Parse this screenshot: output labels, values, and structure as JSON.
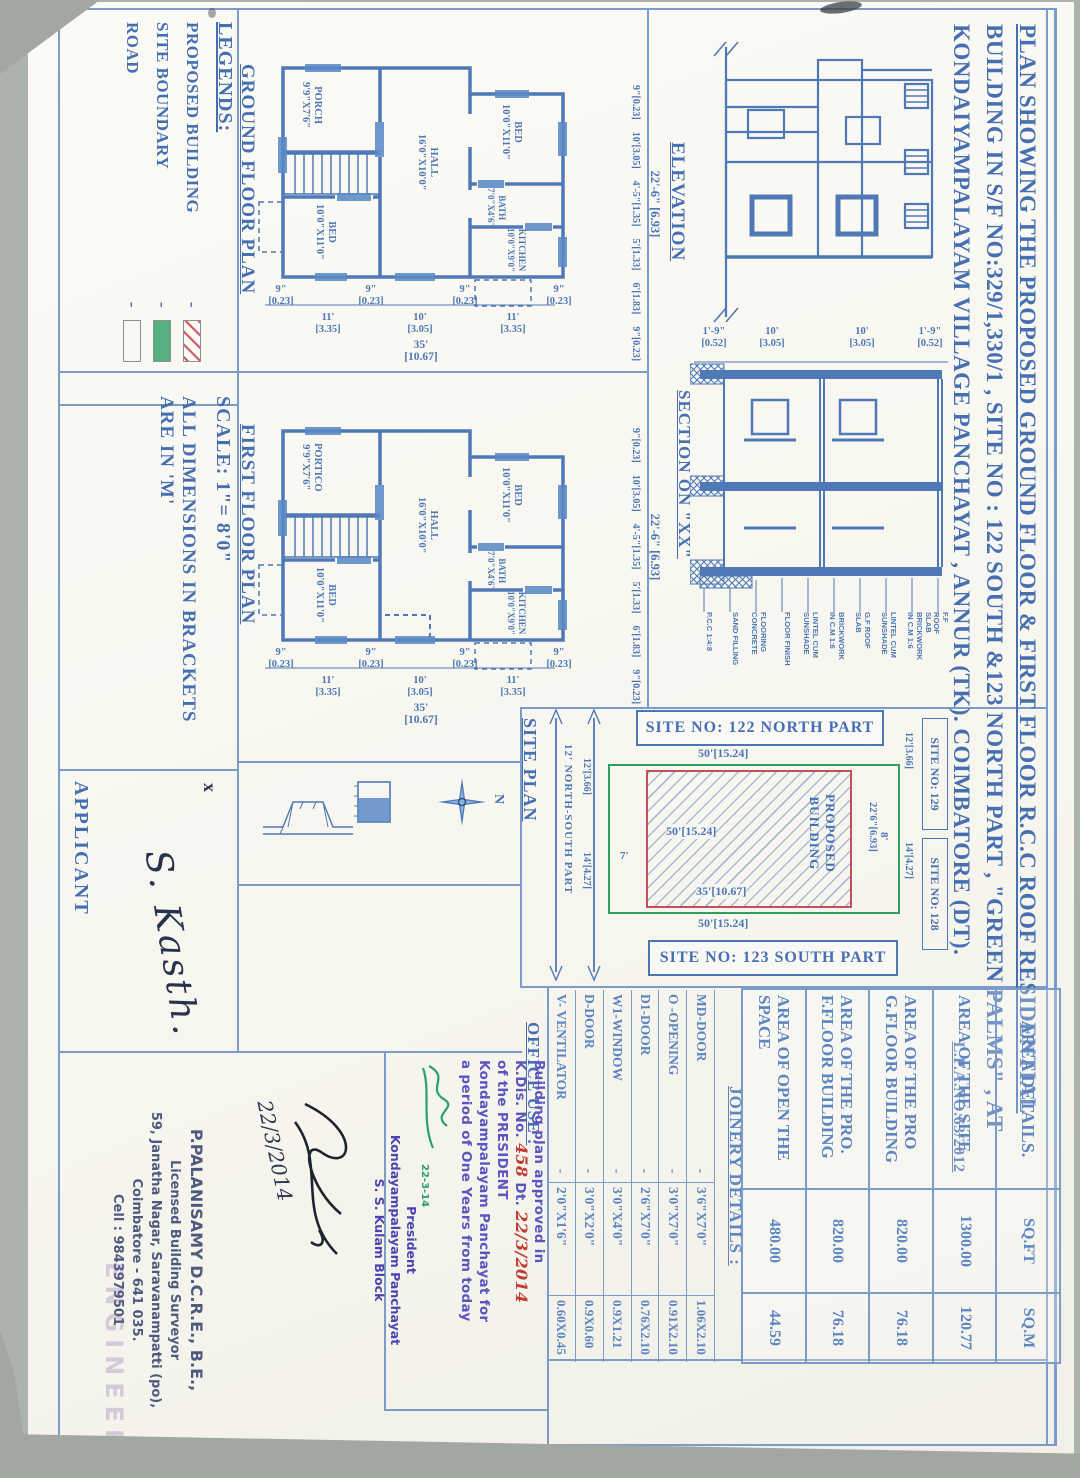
{
  "colors": {
    "ink_blue": "#4c77b4",
    "boundary_green": "#2e9e62",
    "building_red": "#c2505c",
    "stamp_violet": "#5b54c0",
    "hand_red": "#c23b32",
    "signature_green": "#2aa06a"
  },
  "sheet": {
    "title_line1": "PLAN SHOWING THE PROPOSED  GROUND FLOOR  & FIRST FLOOR R.C.C ROOF RESIDENTIAL",
    "title_line2": "BUILDING IN S/F NO:329/1,330/1 , SITE NO : 122 SOUTH &123 NORTH PART , \"GREEN PALMS\" , AT",
    "title_line3": "KONDAIYAMPALAYAM VILLAGE PANCHAYAT , ANNUR (TK). COIMBATORE (DT).",
    "lpa_no": "L.P.A.NO.63/2012"
  },
  "labels": {
    "elevation": "ELEVATION",
    "section": "SECTION ON \"XX\"",
    "ground_floor_plan": "GROUND FLOOR PLAN",
    "first_floor_plan": "FIRST FLOOR PLAN",
    "site_plan": "SITE PLAN",
    "office_use": "OFFICE USE :",
    "applicant": "APPLICANT",
    "applicant_mark": "x",
    "north_letter": "N"
  },
  "legends": {
    "title": "LEGENDS:",
    "sep": "-",
    "items": [
      "PROPOSED BUILDING",
      "SITE BOUNDARY",
      "ROAD"
    ]
  },
  "notes": {
    "scale": "SCALE: 1\"= 8'0\"",
    "dims_line1": "ALL DIMENSIONS IN BRACKETS",
    "dims_line2": "ARE IN 'M'"
  },
  "area_table": {
    "header": {
      "label": "AREA DETAILS.",
      "sqft": "SQ.FT",
      "sqm": "SQ.M"
    },
    "rows": [
      {
        "label": "AREA OF THE SITE",
        "sqft": "1300.00",
        "sqm": "120.77"
      },
      {
        "label": "AREA OF THE PRO G.FLOOR BUILDING",
        "sqft": "820.00",
        "sqm": "76.18"
      },
      {
        "label": "AREA OF THE PRO. F.FLOOR BUILDING",
        "sqft": "820.00",
        "sqm": "76.18"
      },
      {
        "label": "AREA OF OPEN THE SPACE",
        "sqft": "480.00",
        "sqm": "44.59"
      }
    ]
  },
  "joinery_table": {
    "title": "JOINERY DETAILS :",
    "rows": [
      {
        "item": "MD-DOOR",
        "sep": "-",
        "size_ft": "3'6\"X7'0\"",
        "size_m": "1.06X2.10"
      },
      {
        "item": "O -OPENING",
        "sep": "-",
        "size_ft": "3'0\"X7'0\"",
        "size_m": "0.91X2.10"
      },
      {
        "item": "D1-DOOR",
        "sep": "-",
        "size_ft": "2'6\"X7'0\"",
        "size_m": "0.76X2.10"
      },
      {
        "item": "W1-WINDOW",
        "sep": "-",
        "size_ft": "3'0\"X4'0\"",
        "size_m": "0.9X1.21"
      },
      {
        "item": "D-DOOR",
        "sep": "-",
        "size_ft": "3'0\"X2'0\"",
        "size_m": "0.9X0.60"
      },
      {
        "item": "V- VENTILATOR",
        "sep": "-",
        "size_ft": "2'0\"X1'6\"",
        "size_m": "0.60X0.45"
      }
    ]
  },
  "rooms": {
    "gf": {
      "porch": {
        "name": "PORCH",
        "size": "9'9\"X7'6\""
      },
      "hall": {
        "name": "HALL",
        "size": "16'0\"X10'0\""
      },
      "bed_a": {
        "name": "BED",
        "size": "10'0\"X11'0\""
      },
      "bed_b": {
        "name": "BED",
        "size": "10'0\"X11'0\""
      },
      "bath": {
        "name": "BATH",
        "size": "7'0\"X4'6\""
      },
      "kitchen": {
        "name": "KITCHEN",
        "size": "10'0\"X9'0\""
      }
    },
    "ff": {
      "porch": {
        "name": "PORTICO",
        "size": "9'9\"X7'6\""
      },
      "hall": {
        "name": "HALL",
        "size": "16'0\"X10'0\""
      },
      "bed_a": {
        "name": "BED",
        "size": "10'0\"X11'0\""
      },
      "bed_b": {
        "name": "BED",
        "size": "10'0\"X11'0\""
      },
      "bath": {
        "name": "BATH",
        "size": "7'0\"X4'6\""
      },
      "kitchen": {
        "name": "KITCHEN",
        "size": "10'0\"X9'0\""
      }
    }
  },
  "plan_bottom": {
    "wall_ft": "9\"",
    "wall_m": "[0.23]",
    "spans": [
      {
        "ft": "11'",
        "m": "[3.35]"
      },
      {
        "ft": "10'",
        "m": "[3.05]"
      },
      {
        "ft": "11'",
        "m": "[3.35]"
      }
    ],
    "total_ft": "35'",
    "total_m": "[10.67]"
  },
  "plan_side": {
    "total": "22'-6\" [6.93]",
    "segs": [
      "9\"[0.23]",
      "10'[3.05]",
      "4'-5\"[1.35]",
      "5'[1.33]",
      "6'[1.83]",
      "9\"[0.23]"
    ]
  },
  "section": {
    "top_dims": [
      {
        "ft": "1'-9\"",
        "m": "[0.52]"
      },
      {
        "ft": "10'",
        "m": "[3.05]"
      },
      {
        "ft": "10'",
        "m": "[3.05]"
      },
      {
        "ft": "1'-9\"",
        "m": "[0.52]"
      }
    ],
    "callouts": [
      "P.C.C 1:4:8",
      "SAND FILLING",
      "FLOORING\nCONCRETE",
      "FLOOR FINISH",
      "LINTEL CUM\nSUNSHADE",
      "BRICKWORK\nIN C.M 1:6",
      "G.F ROOF\nSLAB",
      "LINTEL CUM\nSUNSHADE",
      "BRICKWORK\nIN C.M 1:6",
      "F.F ROOF\nSLAB"
    ]
  },
  "site_plan": {
    "banner_north": "SITE NO: 122 NORTH PART",
    "banner_south": "SITE NO: 123 SOUTH PART",
    "dim_top": "50'[15.24]",
    "dim_bottom": "50'[15.24]",
    "dim_inner_w": "50'[15.24]",
    "dim_inner_l": "35'[10.67]",
    "dim_inner_h": "22'6\"[6.93]",
    "gap_left": "7'",
    "gap_right": "8'",
    "building_line1": "PROPOSED",
    "building_line2": "BUILDING",
    "site_right_top": "SITE NO: 129",
    "site_right_bottom": "SITE NO: 128",
    "dim_side_a": "12'[3.66]",
    "dim_side_b": "14'[4.27]",
    "road_label": "12' NORTH-SOUTH PART"
  },
  "stamps": {
    "approval": {
      "l1": "Building plan approved in",
      "l2a": "K.Dis. No.",
      "l2b": "458",
      "l2c": "Dt.",
      "l2d": "22/3/2014",
      "l3": "of the PRESIDENT",
      "l4": "Kondayampalayam Panchayat for",
      "l5": "a period of One Years from today",
      "sig_date": "22-3-14",
      "p1": "President",
      "p2": "Kondayampalayam Panchayat",
      "p3": "S. S. Kulam Block"
    },
    "surveyor": {
      "l1": "P.PALANISAMY D.C.R.E., B.E.,",
      "l2": "Licensed Building Surveyor",
      "l3": "59, Janatha Nagar, Saravanampatti (po),",
      "l4": "Coimbatore - 641 035.",
      "l5": "Cell : 9843979501"
    },
    "hand_date": "22/3/2014",
    "watermark": "ENGINEER"
  },
  "signatures": {
    "applicant": "S. Kasth."
  }
}
